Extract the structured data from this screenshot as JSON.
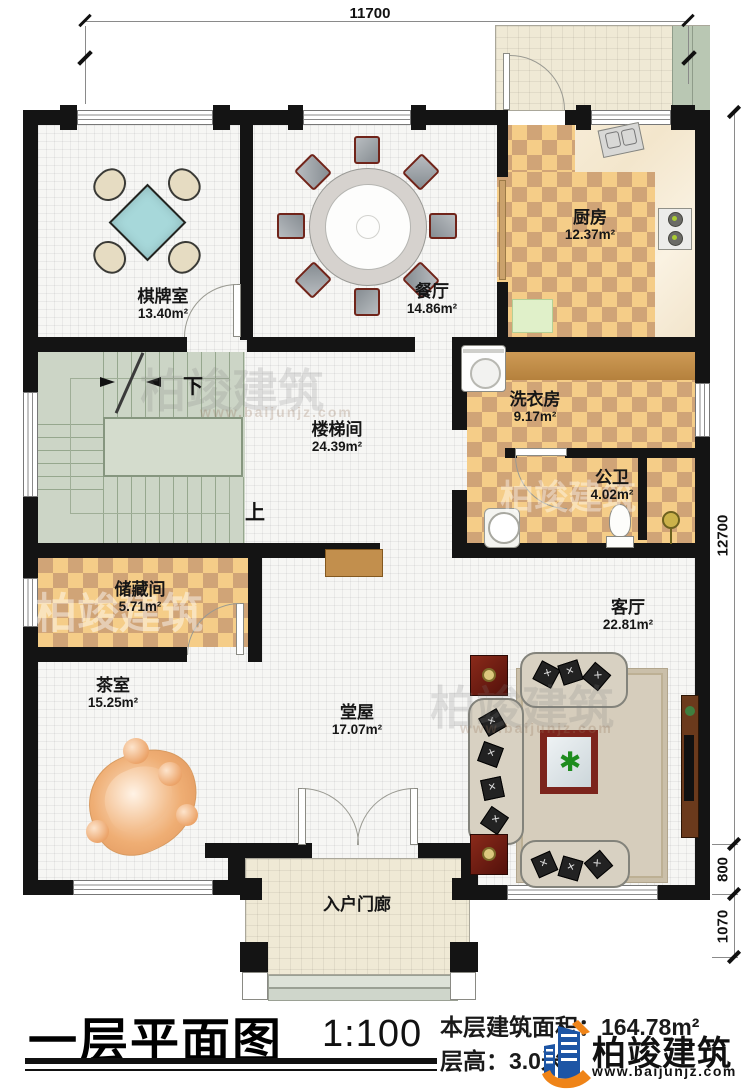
{
  "dimensions": {
    "top": "11700",
    "right_main": "12700",
    "right_mid": "800",
    "right_low": "1070"
  },
  "rooms": [
    {
      "name": "棋牌室",
      "area": "13.40m²"
    },
    {
      "name": "餐厅",
      "area": "14.86m²"
    },
    {
      "name": "厨房",
      "area": "12.37m²"
    },
    {
      "name": "洗衣房",
      "area": "9.17m²"
    },
    {
      "name": "公卫",
      "area": "4.02m²"
    },
    {
      "name": "楼梯间",
      "area": "24.39m²"
    },
    {
      "name": "储藏间",
      "area": "5.71m²"
    },
    {
      "name": "茶室",
      "area": "15.25m²"
    },
    {
      "name": "堂屋",
      "area": "17.07m²"
    },
    {
      "name": "客厅",
      "area": "22.81m²"
    },
    {
      "name": "入户门廊",
      "area": ""
    }
  ],
  "stairs": {
    "down_label": "下",
    "up_label": "上"
  },
  "title": {
    "main": "一层平面图",
    "scale": "1:100",
    "area_line": "本层建筑面积：164.78m²",
    "height_line": "层高：3.0米"
  },
  "logo": {
    "name": "柏竣建筑",
    "url": "www.baijunjz.com"
  },
  "watermark": {
    "text": "柏竣建筑",
    "url": "www.baijunjz.com"
  },
  "colors": {
    "wall": "#141414",
    "checker_light": "#f5cd88",
    "checker_dark": "#d0a477",
    "stair": "#ccd5c6",
    "logo_blue": "#1d55a5",
    "logo_orange": "#ef8418"
  }
}
